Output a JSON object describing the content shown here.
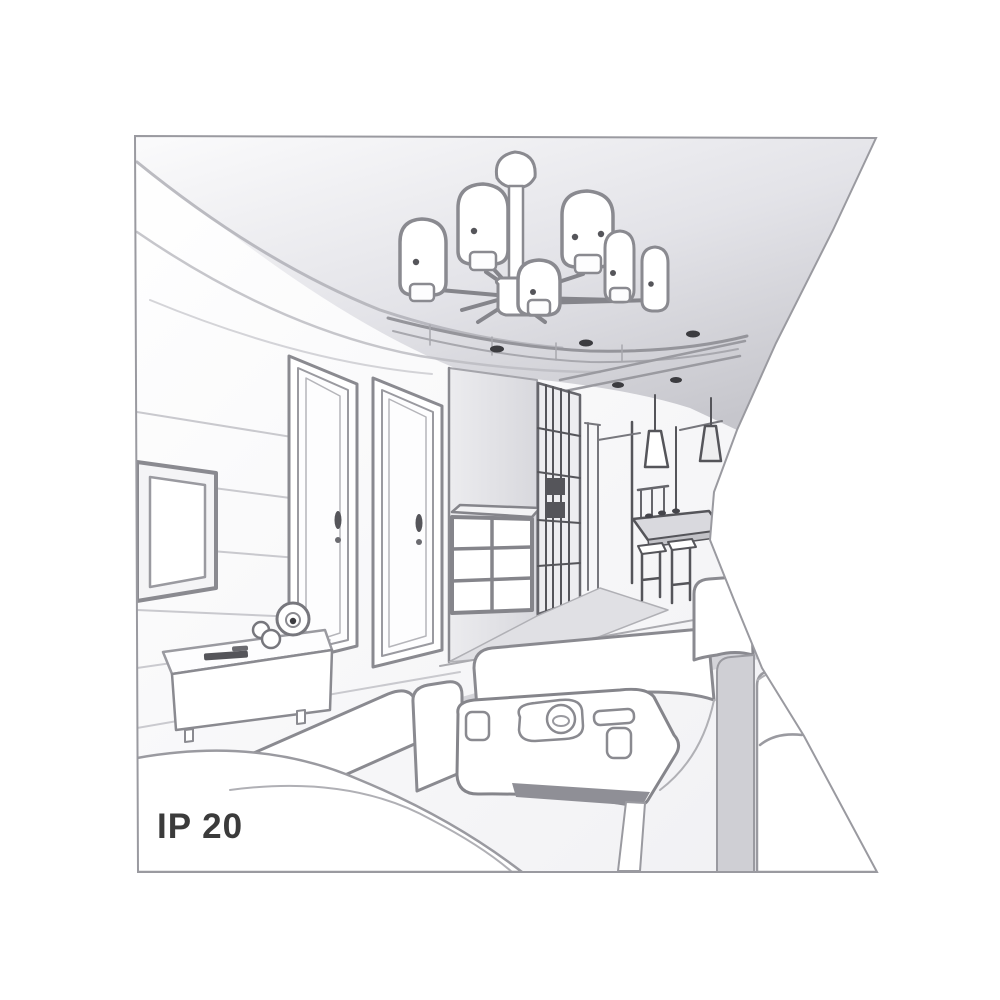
{
  "figure": {
    "ip_label": "IP 20"
  },
  "colors": {
    "background": "#ffffff",
    "line": "#8a8a90",
    "line_dark": "#55555a",
    "line_faint": "#c5c5ca",
    "ceiling_top": "#fafafb",
    "ceiling_dark": "#c6c6cc",
    "wall_panel": "#e3e3e7",
    "floor_mid": "#d4d4d9",
    "sofa_band": "#cfcfd4",
    "table_shadow": "#8f8f96",
    "text": "#3b3b3b"
  }
}
